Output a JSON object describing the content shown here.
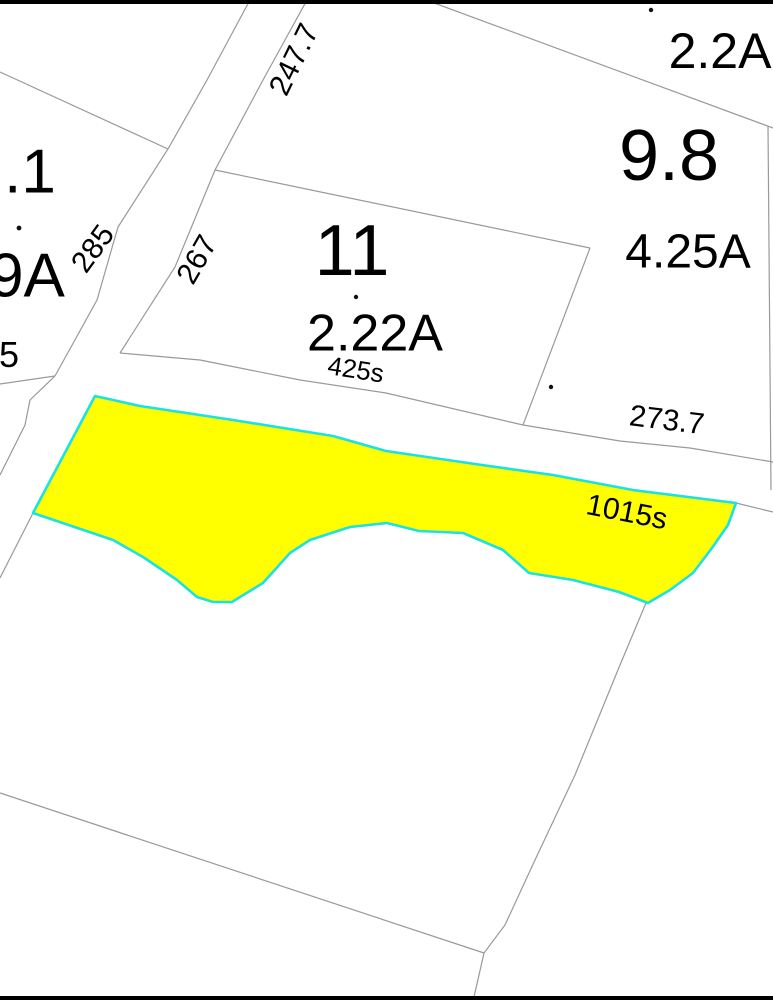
{
  "map": {
    "canvas": {
      "width": 773,
      "height": 1000,
      "background": "#ffffff"
    },
    "colors": {
      "frame": "#000000",
      "parcel_line": "#999999",
      "highlight_fill": "#ffff00",
      "highlight_stroke": "#1ae2e2",
      "label": "#000000"
    },
    "frame_bars": [
      {
        "name": "top-border",
        "x": 0,
        "y": 0,
        "w": 773,
        "h": 4
      },
      {
        "name": "bottom-border",
        "x": 0,
        "y": 996,
        "w": 773,
        "h": 4
      }
    ],
    "highlight_parcel": {
      "name": "highlighted-parcel",
      "frontage_label": "1015s",
      "points": [
        [
          95,
          396
        ],
        [
          140,
          406
        ],
        [
          233,
          420
        ],
        [
          333,
          436
        ],
        [
          386,
          451
        ],
        [
          475,
          464
        ],
        [
          553,
          475
        ],
        [
          633,
          490
        ],
        [
          736,
          503
        ],
        [
          728,
          525
        ],
        [
          712,
          548
        ],
        [
          693,
          573
        ],
        [
          670,
          590
        ],
        [
          648,
          603
        ],
        [
          619,
          592
        ],
        [
          573,
          580
        ],
        [
          529,
          573
        ],
        [
          503,
          550
        ],
        [
          463,
          533
        ],
        [
          419,
          531
        ],
        [
          387,
          523
        ],
        [
          350,
          527
        ],
        [
          310,
          540
        ],
        [
          290,
          553
        ],
        [
          263,
          583
        ],
        [
          232,
          602
        ],
        [
          213,
          602
        ],
        [
          197,
          597
        ],
        [
          177,
          580
        ],
        [
          143,
          557
        ],
        [
          113,
          540
        ],
        [
          33,
          513
        ]
      ]
    },
    "boundary_lines": [
      {
        "name": "road-west-edge",
        "points": [
          [
            250,
            0
          ],
          [
            207,
            80
          ],
          [
            168,
            149
          ],
          [
            118,
            227
          ],
          [
            97,
            300
          ],
          [
            55,
            376
          ]
        ]
      },
      {
        "name": "parcel-north-boundary-left",
        "points": [
          [
            0,
            72
          ],
          [
            168,
            149
          ]
        ]
      },
      {
        "name": "parcel-5-boundary",
        "points": [
          [
            0,
            384
          ],
          [
            55,
            376
          ]
        ]
      },
      {
        "name": "road-west-edge-south",
        "points": [
          [
            55,
            376
          ],
          [
            30,
            400
          ],
          [
            25,
            425
          ],
          [
            0,
            475
          ]
        ]
      },
      {
        "name": "road-east-edge",
        "points": [
          [
            307,
            0
          ],
          [
            263,
            80
          ],
          [
            215,
            170
          ],
          [
            175,
            267
          ],
          [
            120,
            353
          ]
        ]
      },
      {
        "name": "parcel-11-north-boundary",
        "points": [
          [
            215,
            170
          ],
          [
            590,
            248
          ]
        ]
      },
      {
        "name": "parcel-11-east-boundary",
        "points": [
          [
            590,
            248
          ],
          [
            523,
            425
          ]
        ]
      },
      {
        "name": "road-b-north-edge-west",
        "points": [
          [
            120,
            353
          ],
          [
            200,
            360
          ],
          [
            300,
            380
          ],
          [
            386,
            393
          ],
          [
            523,
            425
          ]
        ]
      },
      {
        "name": "road-b-north-edge-east",
        "points": [
          [
            523,
            425
          ],
          [
            620,
            441
          ],
          [
            690,
            448
          ],
          [
            773,
            462
          ]
        ]
      },
      {
        "name": "parcel-98-southwest-boundary",
        "points": [
          [
            426,
            0
          ],
          [
            773,
            128
          ]
        ]
      },
      {
        "name": "east-parcel-boundary",
        "points": [
          [
            768,
            126
          ],
          [
            771,
            490
          ]
        ]
      },
      {
        "name": "road-b-south-edge-east",
        "points": [
          [
            736,
            503
          ],
          [
            773,
            512
          ]
        ]
      },
      {
        "name": "road-east-edge-south",
        "points": [
          [
            33,
            513
          ],
          [
            0,
            578
          ]
        ]
      },
      {
        "name": "bottom-left-diagonal",
        "points": [
          [
            0,
            793
          ],
          [
            484,
            953
          ]
        ]
      },
      {
        "name": "bottom-parcel-boundary",
        "points": [
          [
            646,
            603
          ],
          [
            620,
            665
          ],
          [
            575,
            775
          ],
          [
            535,
            860
          ],
          [
            505,
            925
          ],
          [
            484,
            953
          ],
          [
            474,
            997
          ]
        ]
      }
    ],
    "labels": [
      {
        "name": "label-parcel-1-1",
        "text": ".1",
        "cx": 30,
        "cy": 170,
        "fs": 62,
        "rot": 0
      },
      {
        "name": "label-parcel-9a",
        "text": "9A",
        "cx": 27,
        "cy": 274,
        "fs": 62,
        "rot": 0
      },
      {
        "name": "label-parcel-5",
        "text": "5",
        "cx": 9,
        "cy": 354,
        "fs": 36,
        "rot": 0
      },
      {
        "name": "label-dim-285",
        "text": "285",
        "cx": 92,
        "cy": 248,
        "fs": 30,
        "rot": -54
      },
      {
        "name": "label-dim-267",
        "text": "267",
        "cx": 196,
        "cy": 259,
        "fs": 30,
        "rot": -60
      },
      {
        "name": "label-dim-247-7",
        "text": "247.7",
        "cx": 293,
        "cy": 59,
        "fs": 30,
        "rot": -64
      },
      {
        "name": "label-parcel-11",
        "text": "11",
        "cx": 352,
        "cy": 249,
        "fs": 72,
        "rot": 0
      },
      {
        "name": "label-area-2-22a",
        "text": "2.22A",
        "cx": 375,
        "cy": 332,
        "fs": 52,
        "rot": 0
      },
      {
        "name": "label-dim-425s",
        "text": "425s",
        "cx": 356,
        "cy": 369,
        "fs": 26,
        "rot": 9
      },
      {
        "name": "label-area-2-2a",
        "text": "2.2A",
        "cx": 720,
        "cy": 50,
        "fs": 50,
        "rot": 0
      },
      {
        "name": "label-parcel-9-8",
        "text": "9.8",
        "cx": 669,
        "cy": 154,
        "fs": 72,
        "rot": 0
      },
      {
        "name": "label-area-4-25a",
        "text": "4.25A",
        "cx": 688,
        "cy": 250,
        "fs": 48,
        "rot": 0
      },
      {
        "name": "label-dim-273-7",
        "text": "273.7",
        "cx": 667,
        "cy": 419,
        "fs": 30,
        "rot": 7
      },
      {
        "name": "label-dim-1015s",
        "text": "1015s",
        "cx": 627,
        "cy": 511,
        "fs": 30,
        "rot": 11
      }
    ],
    "point_markers": [
      {
        "name": "point-marker",
        "x": 651,
        "y": 10,
        "r": 2.2
      },
      {
        "name": "point-marker",
        "x": 356,
        "y": 297,
        "r": 2.2
      },
      {
        "name": "point-marker",
        "x": 551,
        "y": 387,
        "r": 2.2
      },
      {
        "name": "point-marker",
        "x": 19,
        "y": 228,
        "r": 2.4
      }
    ]
  }
}
